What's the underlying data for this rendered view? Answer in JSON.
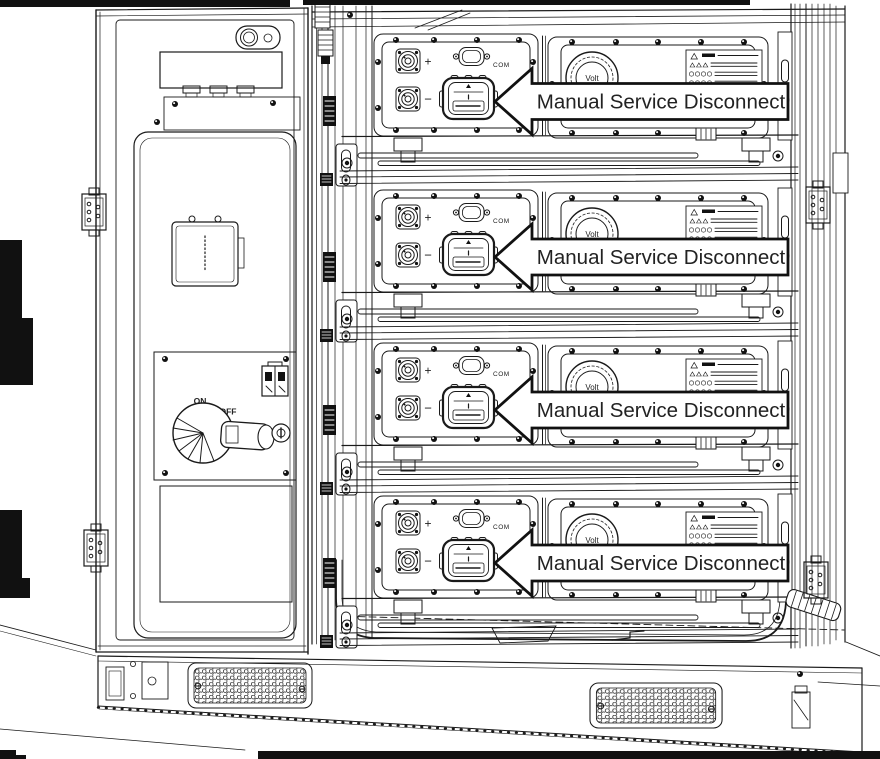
{
  "figure": {
    "description": "Technical line drawing of a battery cabinet with open left door and four battery modules, each with a manual service disconnect callout",
    "background": "#ffffff",
    "line_color": "#1a1a1a"
  },
  "callouts": [
    {
      "label": "Manual Service Disconnect"
    },
    {
      "label": "Manual Service Disconnect"
    },
    {
      "label": "Manual Service Disconnect"
    },
    {
      "label": "Manual Service Disconnect"
    }
  ],
  "modules": {
    "count": 4,
    "labels": {
      "positive": "+",
      "negative": "−",
      "com": "COM",
      "gauge": "Volt"
    }
  },
  "door": {
    "switch": {
      "on": "ON",
      "off": "OFF"
    }
  }
}
